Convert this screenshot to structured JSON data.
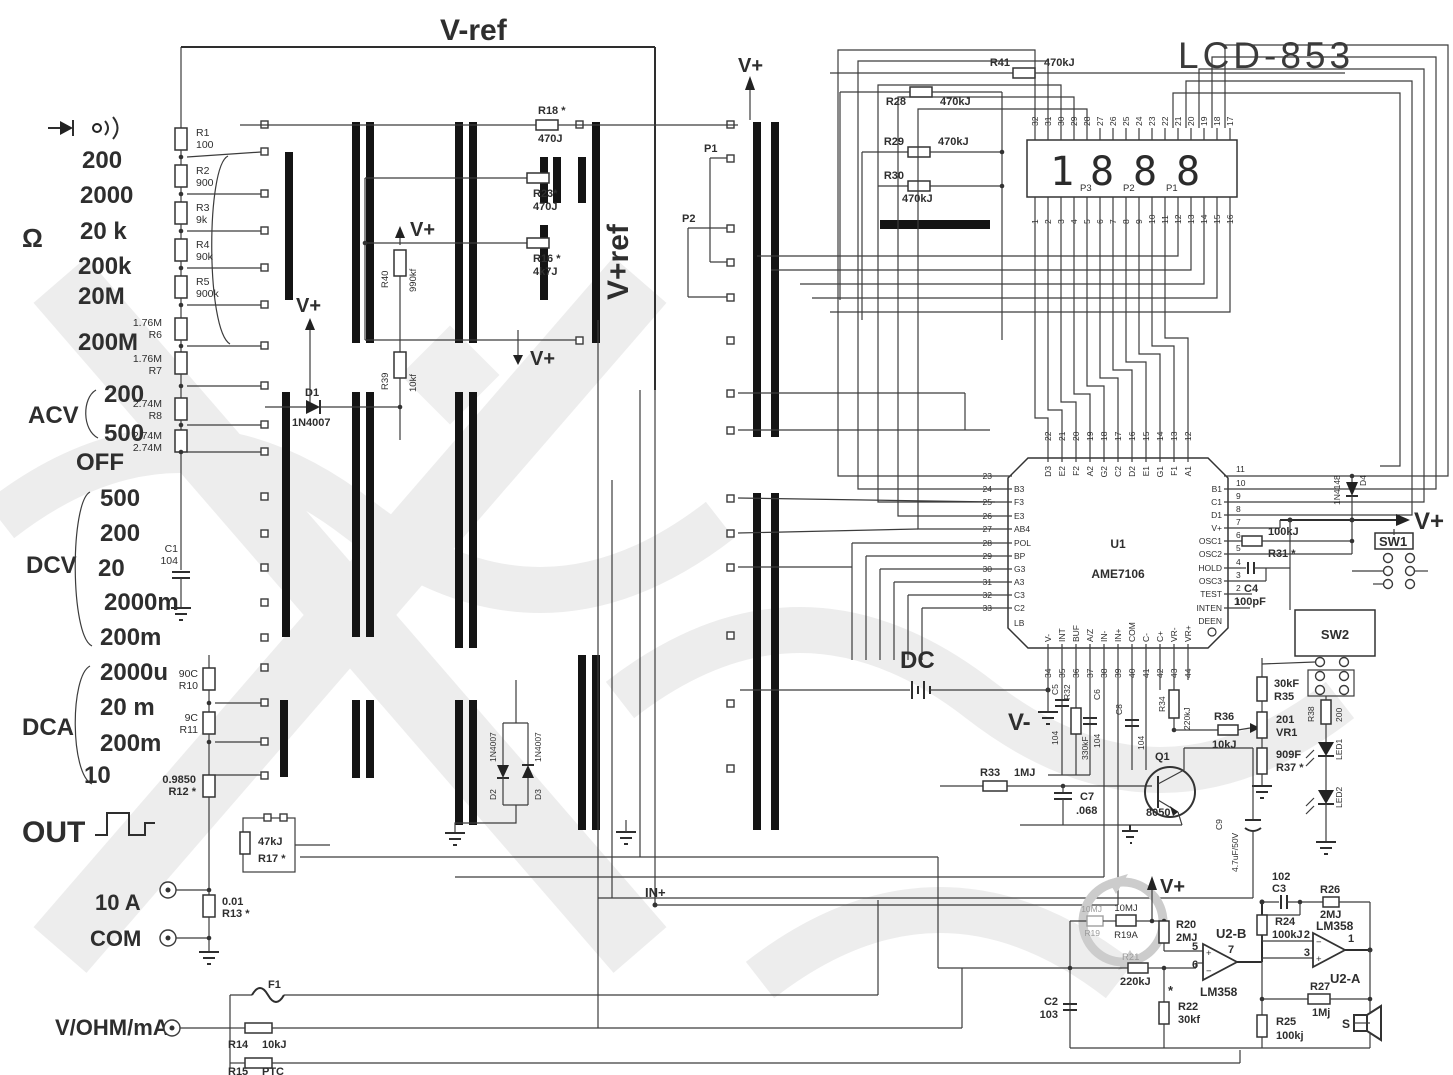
{
  "t": {
    "title": "LCD-853",
    "vref": "V-ref",
    "vpref": "V+ref",
    "vp": "V+",
    "vm": "V-",
    "dc": "DC",
    "inp": "IN+",
    "out": "OUT",
    "off": "OFF",
    "acv": "ACV",
    "dcv": "DCV",
    "dca": "DCA",
    "ohm": "Ω",
    "a10": "10 A",
    "com": "COM",
    "vohm": "V/OHM/mA",
    "p1": "P1",
    "p2": "P2",
    "s": "S",
    "star": "*",
    "lb": "LB",
    "deen": "DEEN",
    "u1": "U1",
    "u1p": "AME7106",
    "u2a": "U2-A",
    "u2b": "U2-B",
    "lm": "LM358",
    "sw1": "SW1",
    "sw2": "SW2",
    "f1": "F1",
    "d4": "D4",
    "n4148": "1N4148"
  },
  "rotary": {
    "ohm_r": [
      "200",
      "2000",
      "20 k",
      "200k",
      "20M",
      "200M"
    ],
    "acv_r": [
      "200",
      "500"
    ],
    "dcv_r": [
      "500",
      "200",
      "20",
      "2000m",
      "200m"
    ],
    "dca_r": [
      "2000u",
      "20 m",
      "200m",
      "10"
    ]
  },
  "parts": {
    "R1": {
      "r": "R1",
      "v": "100"
    },
    "R2": {
      "r": "R2",
      "v": "900"
    },
    "R3": {
      "r": "R3",
      "v": "9k"
    },
    "R4": {
      "r": "R4",
      "v": "90k"
    },
    "R5": {
      "r": "R5",
      "v": "900k"
    },
    "R6": {
      "r": "R6",
      "v": "1.76M"
    },
    "R7": {
      "r": "R7",
      "v": "1.76M"
    },
    "R8": {
      "r": "R8",
      "v": "2.74M"
    },
    "R9": {
      "r": "R9",
      "v": "2.74M"
    },
    "R10": {
      "r": "R10",
      "v": "90C"
    },
    "R11": {
      "r": "R11",
      "v": "9C"
    },
    "R12": {
      "r": "R12 *",
      "v": "0.9850"
    },
    "R13": {
      "r": "R13 *",
      "v": "0.01"
    },
    "R14": {
      "r": "R14",
      "v": "10kJ"
    },
    "R15": {
      "r": "R15",
      "v": "PTC"
    },
    "R16": {
      "r": "R16 *",
      "v": "4k7J"
    },
    "R17": {
      "r": "R17 *",
      "v": "47kJ"
    },
    "R18": {
      "r": "R18 *",
      "v": "470J"
    },
    "R19": {
      "r": "R19",
      "v": "10MJ"
    },
    "R19A": {
      "r": "R19A",
      "v": "10MJ"
    },
    "R20": {
      "r": "R20",
      "v": "2MJ"
    },
    "R21": {
      "r": "R21",
      "v": "220kJ"
    },
    "R22": {
      "r": "R22",
      "v": "30kf"
    },
    "R23": {
      "r": "R23*",
      "v": "470J"
    },
    "R24": {
      "r": "R24",
      "v": "100kJ"
    },
    "R25": {
      "r": "R25",
      "v": "100kj"
    },
    "R26": {
      "r": "R26",
      "v": "2MJ"
    },
    "R27": {
      "r": "R27",
      "v": "1Mj"
    },
    "R28": {
      "r": "R28",
      "v": "470kJ"
    },
    "R29": {
      "r": "R29",
      "v": "470kJ"
    },
    "R30": {
      "r": "R30",
      "v": "470kJ"
    },
    "R31": {
      "r": "R31 *",
      "v": "100kJ"
    },
    "R32": {
      "r": "R32",
      "v": "330kF"
    },
    "R33": {
      "r": "R33",
      "v": "1MJ"
    },
    "R34": {
      "r": "R34",
      "v": "220kJ"
    },
    "R35": {
      "r": "R35",
      "v": "30kF"
    },
    "R36": {
      "r": "R36",
      "v": "10kJ"
    },
    "R37": {
      "r": "R37 *",
      "v": "909F"
    },
    "R38": {
      "r": "R38",
      "v": "200"
    },
    "R39": {
      "r": "R39",
      "v": "10kf"
    },
    "R40": {
      "r": "R40",
      "v": "990kf"
    },
    "R41": {
      "r": "R41",
      "v": "470kJ"
    },
    "C1": {
      "r": "C1",
      "v": "104"
    },
    "C2": {
      "r": "C2",
      "v": "103"
    },
    "C3": {
      "r": "C3",
      "v": "102"
    },
    "C4": {
      "r": "C4",
      "v": "100pF"
    },
    "C5": {
      "r": "C5",
      "v": "104"
    },
    "C6": {
      "r": "C6",
      "v": "104"
    },
    "C7": {
      "r": "C7",
      "v": ".068"
    },
    "C8": {
      "r": "C8",
      "v": "104"
    },
    "C9": {
      "r": "C9",
      "v": "4.7uF/50V"
    },
    "D1": {
      "r": "D1",
      "v": "1N4007"
    },
    "D2": {
      "r": "D2",
      "v": "1N4007"
    },
    "D3": {
      "r": "D3",
      "v": "1N4007"
    },
    "Q1": {
      "r": "Q1",
      "v": "8050"
    },
    "VR1": {
      "r": "VR1",
      "v": "201"
    },
    "LED1": {
      "r": "LED1"
    },
    "LED2": {
      "r": "LED2"
    }
  },
  "lcd": {
    "d": [
      "1",
      "8",
      "8",
      "8"
    ],
    "p": [
      "P3",
      "P2",
      "P1"
    ],
    "tp": [
      "32",
      "31",
      "30",
      "29",
      "28",
      "27",
      "26",
      "25",
      "24",
      "23",
      "22",
      "21",
      "20",
      "19",
      "18",
      "17"
    ],
    "bp": [
      "1",
      "2",
      "3",
      "4",
      "5",
      "6",
      "7",
      "8",
      "9",
      "10",
      "11",
      "12",
      "13",
      "14",
      "15",
      "16"
    ]
  },
  "u1": {
    "top": [
      {
        "n": "22",
        "l": "D3"
      },
      {
        "n": "21",
        "l": "E2"
      },
      {
        "n": "20",
        "l": "F2"
      },
      {
        "n": "19",
        "l": "A2"
      },
      {
        "n": "18",
        "l": "G2"
      },
      {
        "n": "17",
        "l": "C2"
      },
      {
        "n": "16",
        "l": "D2"
      },
      {
        "n": "15",
        "l": "E1"
      },
      {
        "n": "14",
        "l": "G1"
      },
      {
        "n": "13",
        "l": "F1"
      },
      {
        "n": "12",
        "l": "A1"
      }
    ],
    "left": [
      {
        "n": "23",
        "l": ""
      },
      {
        "n": "24",
        "l": "B3"
      },
      {
        "n": "25",
        "l": "F3"
      },
      {
        "n": "26",
        "l": "E3"
      },
      {
        "n": "27",
        "l": "AB4"
      },
      {
        "n": "28",
        "l": "POL"
      },
      {
        "n": "29",
        "l": "BP"
      },
      {
        "n": "30",
        "l": "G3"
      },
      {
        "n": "31",
        "l": "A3"
      },
      {
        "n": "32",
        "l": "C3"
      },
      {
        "n": "33",
        "l": "C2"
      }
    ],
    "right": [
      {
        "n": "11",
        "l": ""
      },
      {
        "n": "10",
        "l": "B1"
      },
      {
        "n": "9",
        "l": "C1"
      },
      {
        "n": "8",
        "l": "D1"
      },
      {
        "n": "7",
        "l": "V+"
      },
      {
        "n": "6",
        "l": "OSC1"
      },
      {
        "n": "5",
        "l": "OSC2"
      },
      {
        "n": "4",
        "l": "HOLD"
      },
      {
        "n": "3",
        "l": "OSC3"
      },
      {
        "n": "2",
        "l": "TEST"
      },
      {
        "n": "1",
        "l": "INTEN"
      }
    ],
    "bottom": [
      {
        "n": "34",
        "l": "V-"
      },
      {
        "n": "35",
        "l": "INT"
      },
      {
        "n": "36",
        "l": "BUF"
      },
      {
        "n": "37",
        "l": "A/Z"
      },
      {
        "n": "38",
        "l": "IN-"
      },
      {
        "n": "39",
        "l": "IN+"
      },
      {
        "n": "40",
        "l": "COM"
      },
      {
        "n": "41",
        "l": "C-"
      },
      {
        "n": "42",
        "l": "C+"
      },
      {
        "n": "43",
        "l": "VR-"
      },
      {
        "n": "44",
        "l": "VR+"
      }
    ]
  },
  "u2": {
    "b5": "5",
    "b6": "6",
    "b7": "7",
    "a1": "1",
    "a2": "2",
    "a3": "3"
  }
}
